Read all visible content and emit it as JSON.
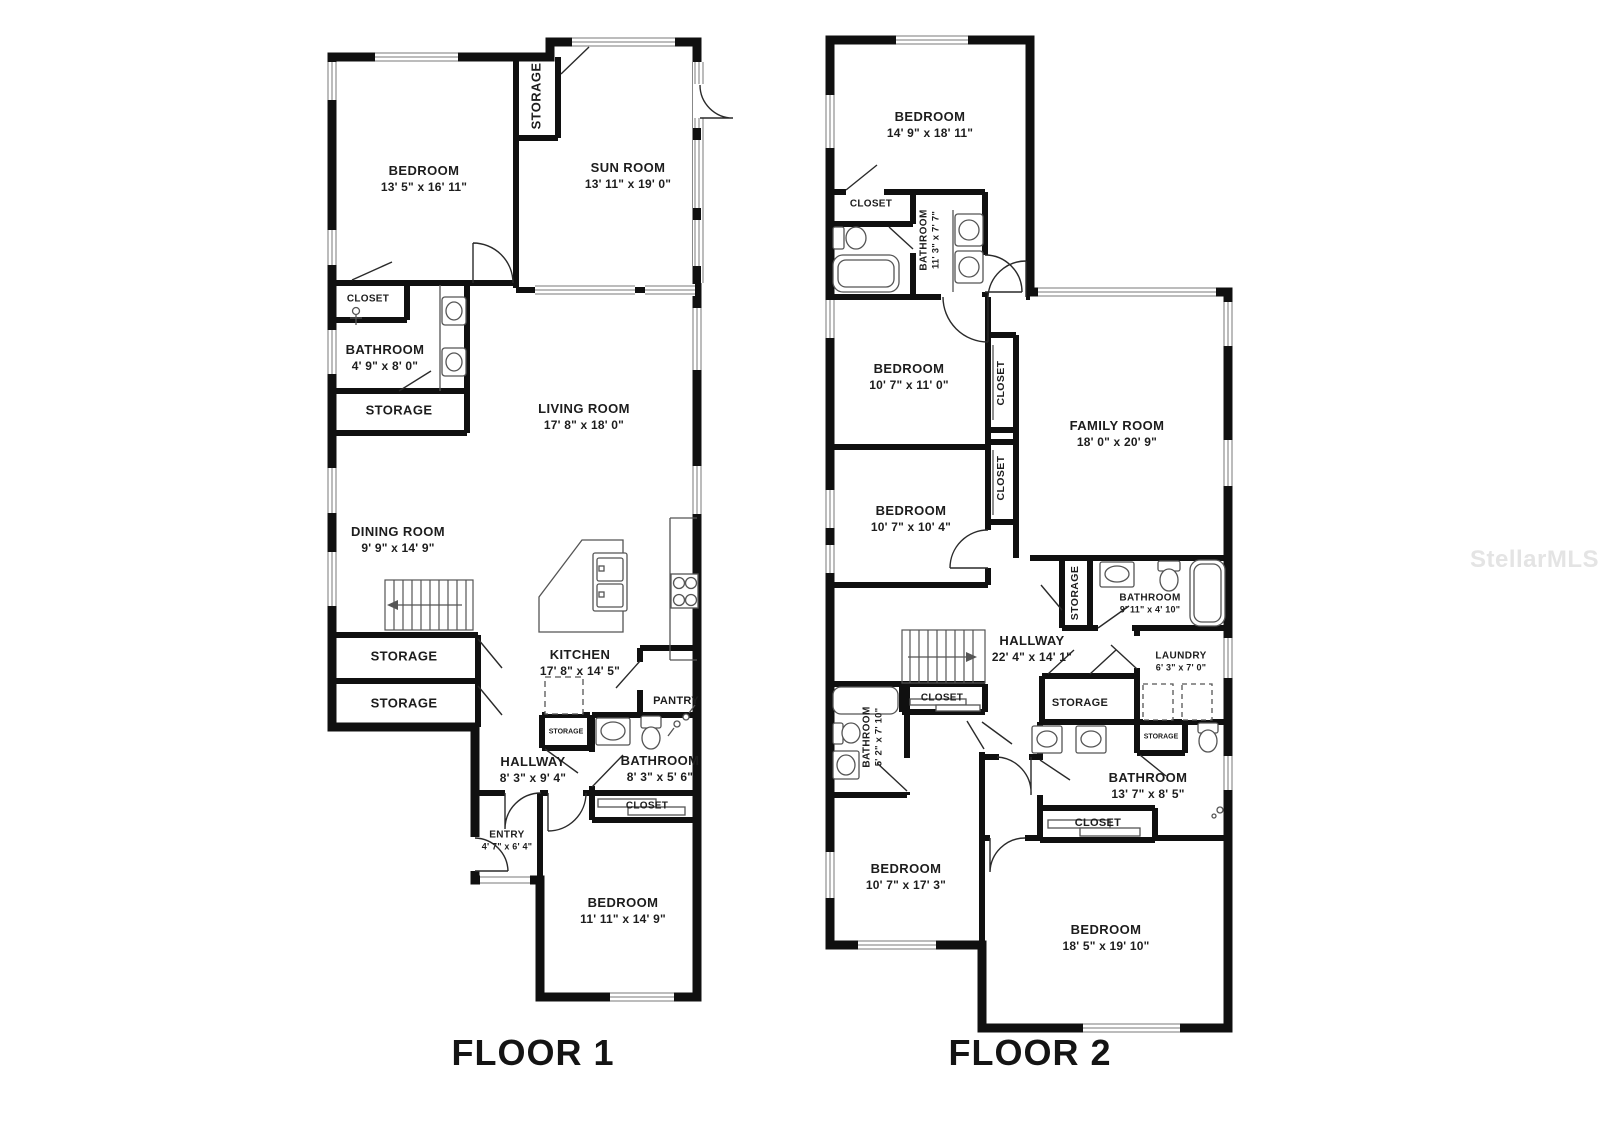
{
  "watermark": "StellarMLS",
  "colors": {
    "wall": "#101010",
    "fixture": "#555555",
    "label": "#1d1d1d",
    "watermark": "#e4e4e4"
  },
  "floor1": {
    "title": "FLOOR 1",
    "rooms": [
      {
        "name": "BEDROOM",
        "dims": "13' 5\" x 16' 11\""
      },
      {
        "name": "STORAGE"
      },
      {
        "name": "SUN ROOM",
        "dims": "13' 11\" x 19' 0\""
      },
      {
        "name": "CLOSET"
      },
      {
        "name": "BATHROOM",
        "dims": "4' 9\" x 8' 0\""
      },
      {
        "name": "STORAGE"
      },
      {
        "name": "LIVING ROOM",
        "dims": "17' 8\" x 18' 0\""
      },
      {
        "name": "DINING ROOM",
        "dims": "9' 9\" x 14' 9\""
      },
      {
        "name": "STORAGE"
      },
      {
        "name": "STORAGE"
      },
      {
        "name": "KITCHEN",
        "dims": "17' 8\" x 14' 5\""
      },
      {
        "name": "PANTRY"
      },
      {
        "name": "STORAGE"
      },
      {
        "name": "HALLWAY",
        "dims": "8' 3\" x 9' 4\""
      },
      {
        "name": "BATHROOM",
        "dims": "8' 3\" x 5' 6\""
      },
      {
        "name": "CLOSET"
      },
      {
        "name": "ENTRY",
        "dims": "4' 7\" x 6' 4\""
      },
      {
        "name": "BEDROOM",
        "dims": "11' 11\" x 14' 9\""
      }
    ]
  },
  "floor2": {
    "title": "FLOOR 2",
    "rooms": [
      {
        "name": "BEDROOM",
        "dims": "14' 9\" x 18' 11\""
      },
      {
        "name": "CLOSET"
      },
      {
        "name": "BATHROOM",
        "dims": "11' 3\" x 7' 7\""
      },
      {
        "name": "BEDROOM",
        "dims": "10' 7\" x 11' 0\""
      },
      {
        "name": "CLOSET"
      },
      {
        "name": "CLOSET"
      },
      {
        "name": "FAMILY ROOM",
        "dims": "18' 0\" x 20' 9\""
      },
      {
        "name": "BEDROOM",
        "dims": "10' 7\" x 10' 4\""
      },
      {
        "name": "STORAGE"
      },
      {
        "name": "BATHROOM",
        "dims": "9' 11\" x 4' 10\""
      },
      {
        "name": "HALLWAY",
        "dims": "22' 4\" x 14' 1\""
      },
      {
        "name": "LAUNDRY",
        "dims": "6' 3\" x 7' 0\""
      },
      {
        "name": "CLOSET"
      },
      {
        "name": "BATHROOM",
        "dims": "5' 2\" x 7' 10\""
      },
      {
        "name": "STORAGE"
      },
      {
        "name": "STORAGE"
      },
      {
        "name": "BATHROOM",
        "dims": "13' 7\" x 8' 5\""
      },
      {
        "name": "CLOSET"
      },
      {
        "name": "BEDROOM",
        "dims": "10' 7\" x 17' 3\""
      },
      {
        "name": "BEDROOM",
        "dims": "18' 5\" x 19' 10\""
      }
    ]
  }
}
